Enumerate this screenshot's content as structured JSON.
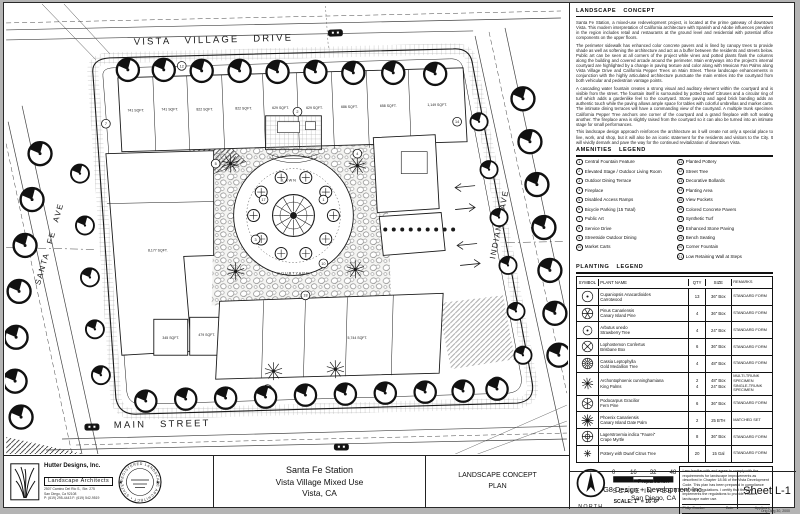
{
  "plan": {
    "streets": {
      "top": "VISTA VILLAGE DRIVE",
      "left": "SANTA FE AVE",
      "right": "INDIANA AVE",
      "bottom": "MAIN STREET"
    },
    "area_labels": [
      {
        "text": "741 SQFT.",
        "x": 130,
        "y": 108
      },
      {
        "text": "741 SQFT.",
        "x": 164,
        "y": 107
      },
      {
        "text": "822 SQFT.",
        "x": 199,
        "y": 107
      },
      {
        "text": "822 SQFT.",
        "x": 238,
        "y": 106
      },
      {
        "text": "629 SQFT.",
        "x": 275,
        "y": 105
      },
      {
        "text": "629 SQFT.",
        "x": 309,
        "y": 105
      },
      {
        "text": "686 SQFT.",
        "x": 344,
        "y": 104
      },
      {
        "text": "658 SQFT.",
        "x": 383,
        "y": 103
      },
      {
        "text": "1,149 SQFT.",
        "x": 432,
        "y": 102
      },
      {
        "text": "8,177 SQFT.",
        "x": 152,
        "y": 248
      },
      {
        "text": "345 SQFT.",
        "x": 165,
        "y": 336
      },
      {
        "text": "479 SQFT.",
        "x": 201,
        "y": 333
      },
      {
        "text": "5,744 SQFT.",
        "x": 352,
        "y": 336
      }
    ],
    "courtyard_labels": [
      {
        "text": "LAWN",
        "x": 284,
        "y": 178
      },
      {
        "text": "COURTYARD",
        "x": 288,
        "y": 271
      }
    ],
    "callouts": [
      {
        "n": "1",
        "x": 318,
        "y": 196
      },
      {
        "n": "2",
        "x": 292,
        "y": 108
      },
      {
        "n": "3",
        "x": 250,
        "y": 236
      },
      {
        "n": "4",
        "x": 352,
        "y": 150
      },
      {
        "n": "5",
        "x": 210,
        "y": 160
      },
      {
        "n": "7",
        "x": 100,
        "y": 120
      },
      {
        "n": "9",
        "x": 262,
        "y": 386
      },
      {
        "n": "10",
        "x": 318,
        "y": 260
      },
      {
        "n": "12",
        "x": 176,
        "y": 62
      },
      {
        "n": "14",
        "x": 452,
        "y": 118
      },
      {
        "n": "17",
        "x": 258,
        "y": 196
      },
      {
        "n": "18",
        "x": 300,
        "y": 292
      }
    ]
  },
  "concept": {
    "title": "LANDSCAPE CONCEPT",
    "paragraphs": [
      "Santa Fe Station, a mixed-use redevelopment project, is located at the prime gateway of downtown Vista.  This modern interpretation of California architecture with Spanish and Adobe influences prevalent in the region includes retail and restaurants at the ground level and residential with potential office components on the upper floors.",
      "The perimeter sidewalk has enhanced color concrete pavers and is lined by canopy trees to provide shade as well as softening the architecture and act as a buffer between the residents and streets below.  Public art can be seen at all corners of the project while vines and potted plants flank the columns along the building and covered arcade around the perimeter.  Main entryways into the project's internal courtyard are highlighted by a change in paving texture and color along with Mexican Fan Palms along Vista Village Drive and California Pepper Trees on Main Street.  These landscape enhancements in conjunction with the highly articulated architecture punctuate the main entries into the courtyard from both vehicular and pedestrian vantage points.",
      "A cascading water fountain creates a strong visual and auditory element within the courtyard and is visible from the street.  The fountain itself is surrounded by potted Dwarf Citruses and a circular ring of turf which adds a gardenlike feel to the courtyard.  Stone paving and aged brick banding adds an authentic touch while the paving allows ample space for tables with colorful umbrellas and market carts.  The intimate dining terraces will have a commanding view of the courtyard.  A multiple trunk specimen California Pepper Tree anchors one corner of the courtyard and a grand fireplace with soft seating another.  The fireplace area is slightly raised from the courtyard so it can also be turned into an intimate stage for small performances.",
      "This landscape design approach reinforces the architecture as it will create not only a special place to live, work, and shop, but it will also be an iconic statement for the residents and visitors to the City.  It will vividly demark and pave the way for the continued revitalization of downtown Vista."
    ]
  },
  "amenities": {
    "title": "AMENITIES LEGEND",
    "left": [
      {
        "n": "1",
        "label": "Central Fountain Feature"
      },
      {
        "n": "2",
        "label": "Elevated Stage / Outdoor Living Room"
      },
      {
        "n": "3",
        "label": "Outdoor Dining Terrace"
      },
      {
        "n": "4",
        "label": "Fireplace"
      },
      {
        "n": "5",
        "label": "Disabled Access Ramps"
      },
      {
        "n": "6",
        "label": "Bicycle Parking (15 Total)"
      },
      {
        "n": "7",
        "label": "Public Art"
      },
      {
        "n": "8",
        "label": "Service Drive"
      },
      {
        "n": "9",
        "label": "Streetside Outdoor Dining"
      },
      {
        "n": "10",
        "label": "Market Carts"
      }
    ],
    "right": [
      {
        "n": "11",
        "label": "Planted Pottery"
      },
      {
        "n": "12",
        "label": "Street Tree"
      },
      {
        "n": "13",
        "label": "Decorative Bollards"
      },
      {
        "n": "14",
        "label": "Planting Area"
      },
      {
        "n": "15",
        "label": "View Pockets"
      },
      {
        "n": "16",
        "label": "Colored Concrete Pavers"
      },
      {
        "n": "17",
        "label": "Synthetic Turf"
      },
      {
        "n": "18",
        "label": "Enhanced Stone Paving"
      },
      {
        "n": "19",
        "label": "Bench Seating"
      },
      {
        "n": "20",
        "label": "Corner Fountain"
      },
      {
        "n": "21",
        "label": "Low Retaining Wall at Steps"
      }
    ]
  },
  "planting": {
    "title": "PLANTING LEGEND",
    "headers": [
      "SYMBOL",
      "PLANT NAME",
      "QTY",
      "SIZE",
      "REMARKS"
    ],
    "rows": [
      {
        "sym": 0,
        "botanical": "Cupaniopsis Anacardioides",
        "common": "Carrotwood",
        "qty": "13",
        "size": "36\" Box",
        "remarks": "STANDARD FORM"
      },
      {
        "sym": 1,
        "botanical": "Pinus Canariensis",
        "common": "Canary Island Pine",
        "qty": "4",
        "size": "36\" Box",
        "remarks": "STANDARD FORM"
      },
      {
        "sym": 2,
        "botanical": "Arbutus unedo",
        "common": "Strawberry Tree",
        "qty": "4",
        "size": "24\" Box",
        "remarks": "STANDARD FORM"
      },
      {
        "sym": 3,
        "botanical": "Lophostemon Confertus",
        "common": "Brisbane Box",
        "qty": "6",
        "size": "36\" Box",
        "remarks": "STANDARD FORM"
      },
      {
        "sym": 4,
        "botanical": "Cassia Leptophylla",
        "common": "Gold Medallion Tree",
        "qty": "4",
        "size": "48\" Box",
        "remarks": "STANDARD FORM"
      },
      {
        "sym": 5,
        "botanical": "Archontophoenix cunninghamiana",
        "common": "King Palms",
        "qty": "2\n4",
        "size": "48\" Box\n24\" Box",
        "remarks": "MULTI-TRUNK SPECIMEN\nSINGLE-TRUNK SPECIMEN"
      },
      {
        "sym": 6,
        "botanical": "Podocarpus Gracilior",
        "common": "Fern Pine",
        "qty": "6",
        "size": "36\" Box",
        "remarks": "STANDARD FORM"
      },
      {
        "sym": 7,
        "botanical": "Phoenix Canariensis",
        "common": "Canary Island Date Palm",
        "qty": "2",
        "size": "25 BTH",
        "remarks": "MATCHED SET"
      },
      {
        "sym": 8,
        "botanical": "Lagerstroemia indica \"Faurei\"",
        "common": "Crape Myrtle",
        "qty": "8",
        "size": "36\" Box",
        "remarks": "STANDARD FORM"
      },
      {
        "sym": 9,
        "botanical": "Pottery with Dwarf Citrus Tree",
        "common": "",
        "qty": "20",
        "size": "15 Gal",
        "remarks": "STANDARD FORM"
      }
    ]
  },
  "scalebar": {
    "ticks": [
      "0",
      "16",
      "32",
      "48"
    ],
    "caption": "SCALE IN FEET",
    "ratio": "SCALE: 1\" = 16'-0\"",
    "north": "NORTH"
  },
  "compliance": {
    "text": "I am familiar with and agree to comply with the requirements for landscape improvements as described in Chapter 18.56 of the Vista Development Code. This plan has been prepared in compliance with those regulations. I certify that the plan implements the regulations to provide efficient landscape water use.",
    "rows": [
      {
        "name": "Philip Crocker",
        "date": "Date",
        "role": "Applicant"
      },
      {
        "name": "Steve Hutter",
        "date": "Date",
        "role": "Land. Architect"
      }
    ]
  },
  "firm": {
    "name": "Hutter Designs, Inc.",
    "type": "Landscape Architects",
    "addr": [
      "2507 Camino Del Rio S., Ste. 275",
      "San Diego, Ca 92108",
      "P: (619) 295-4443   F: (619) 542-9519"
    ],
    "stamp": "REGISTERED LANDSCAPE ARCHITECT • STATE OF CALIFORNIA •"
  },
  "titleblock": {
    "project": [
      "Santa Fe Station",
      "Vista Village Mixed Use",
      "Vista, CA"
    ],
    "drawing": [
      "LANDSCAPE CONCEPT",
      "PLAN"
    ],
    "prepared_label": "Prepared for:",
    "client": [
      "G8 Design + Development Inc.",
      "San Diego, CA"
    ],
    "sheet": "Sheet L-1",
    "orig_note": "Orig Dwg 30, 2000"
  }
}
